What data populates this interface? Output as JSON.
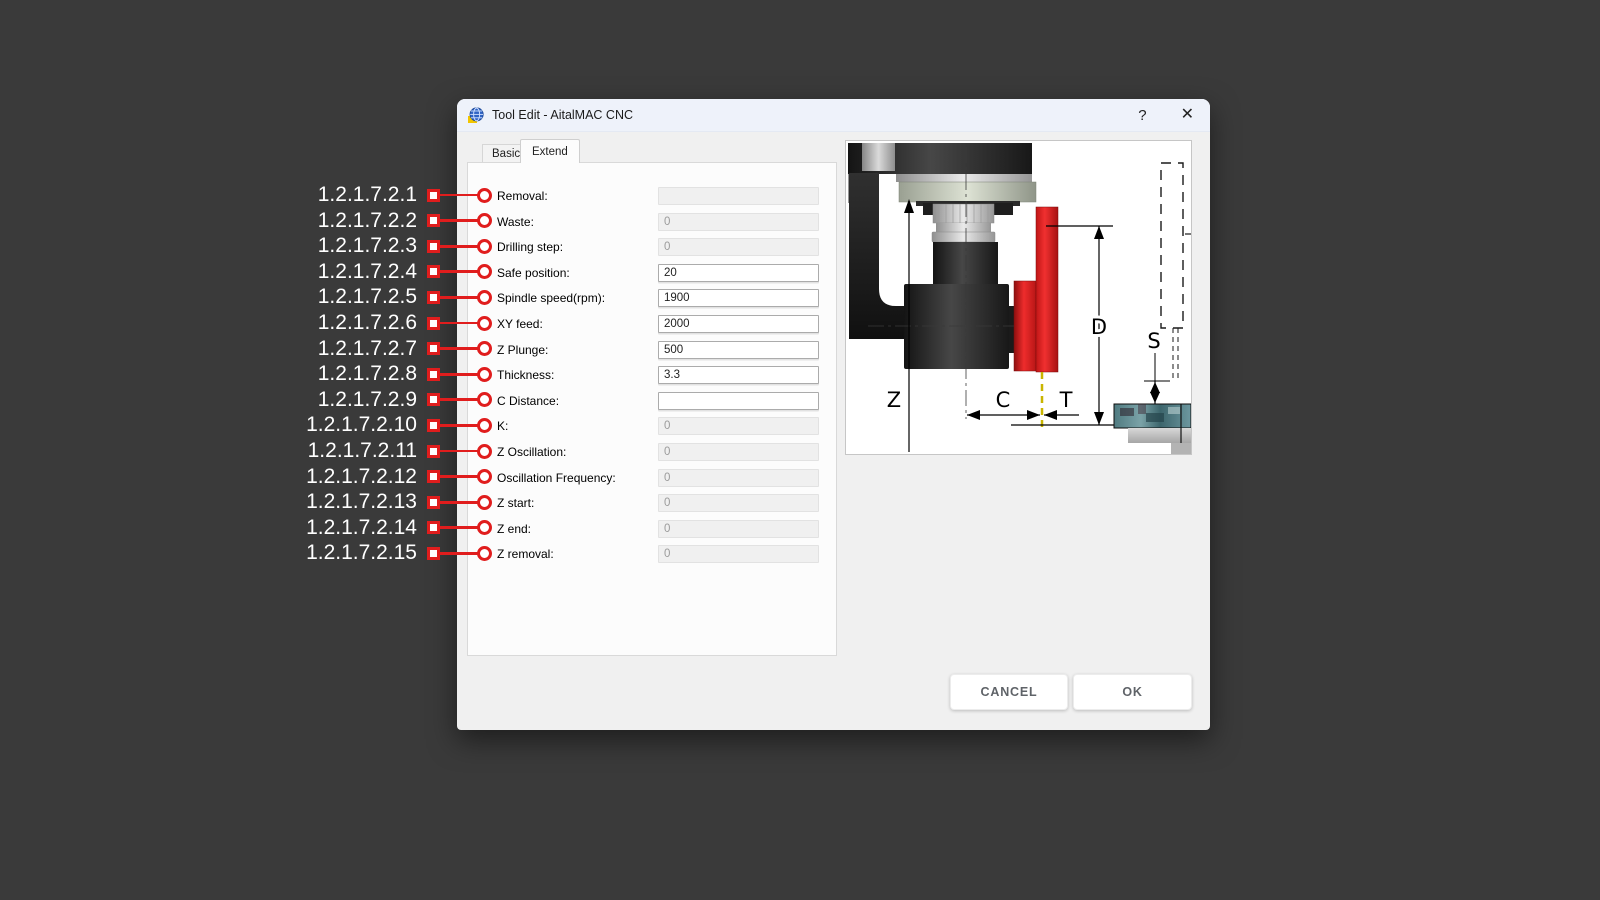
{
  "window": {
    "title": "Tool Edit - AitalMAC CNC",
    "icon": "globe-icon",
    "help_label": "?",
    "close_label": "✕"
  },
  "tabs": [
    {
      "label": "Basic",
      "active": false
    },
    {
      "label": "Extend",
      "active": true
    }
  ],
  "fields": [
    {
      "id": "removal",
      "label": "Removal:",
      "value": "",
      "enabled": false,
      "ref": "1.2.1.7.2.1"
    },
    {
      "id": "waste",
      "label": "Waste:",
      "value": "0",
      "enabled": false,
      "ref": "1.2.1.7.2.2"
    },
    {
      "id": "drilling-step",
      "label": "Drilling step:",
      "value": "0",
      "enabled": false,
      "ref": "1.2.1.7.2.3"
    },
    {
      "id": "safe-position",
      "label": "Safe position:",
      "value": "20",
      "enabled": true,
      "ref": "1.2.1.7.2.4"
    },
    {
      "id": "spindle-speed",
      "label": "Spindle speed(rpm):",
      "value": "1900",
      "enabled": true,
      "ref": "1.2.1.7.2.5"
    },
    {
      "id": "xy-feed",
      "label": "XY feed:",
      "value": "2000",
      "enabled": true,
      "ref": "1.2.1.7.2.6"
    },
    {
      "id": "z-plunge",
      "label": "Z Plunge:",
      "value": "500",
      "enabled": true,
      "ref": "1.2.1.7.2.7"
    },
    {
      "id": "thickness",
      "label": "Thickness:",
      "value": "3.3",
      "enabled": true,
      "ref": "1.2.1.7.2.8"
    },
    {
      "id": "c-distance",
      "label": "C Distance:",
      "value": "",
      "enabled": true,
      "ref": "1.2.1.7.2.9"
    },
    {
      "id": "k",
      "label": "K:",
      "value": "0",
      "enabled": false,
      "ref": "1.2.1.7.2.10"
    },
    {
      "id": "z-oscillation",
      "label": "Z Oscillation:",
      "value": "0",
      "enabled": false,
      "ref": "1.2.1.7.2.11"
    },
    {
      "id": "oscillation-frequency",
      "label": "Oscillation Frequency:",
      "value": "0",
      "enabled": false,
      "ref": "1.2.1.7.2.12"
    },
    {
      "id": "z-start",
      "label": "Z start:",
      "value": "0",
      "enabled": false,
      "ref": "1.2.1.7.2.13"
    },
    {
      "id": "z-end",
      "label": "Z end:",
      "value": "0",
      "enabled": false,
      "ref": "1.2.1.7.2.14"
    },
    {
      "id": "z-removal",
      "label": "Z removal:",
      "value": "0",
      "enabled": false,
      "ref": "1.2.1.7.2.15"
    }
  ],
  "buttons": {
    "cancel": "CANCEL",
    "ok": "OK"
  },
  "diagram": {
    "dimension_labels": {
      "z": "Z",
      "c": "C",
      "t": "T",
      "d": "D",
      "s": "S"
    }
  },
  "colors": {
    "background": "#3a3a3a",
    "annotation_red": "#e01d1d",
    "blade_red": "#e32424",
    "titlebar": "#eef2fa"
  }
}
